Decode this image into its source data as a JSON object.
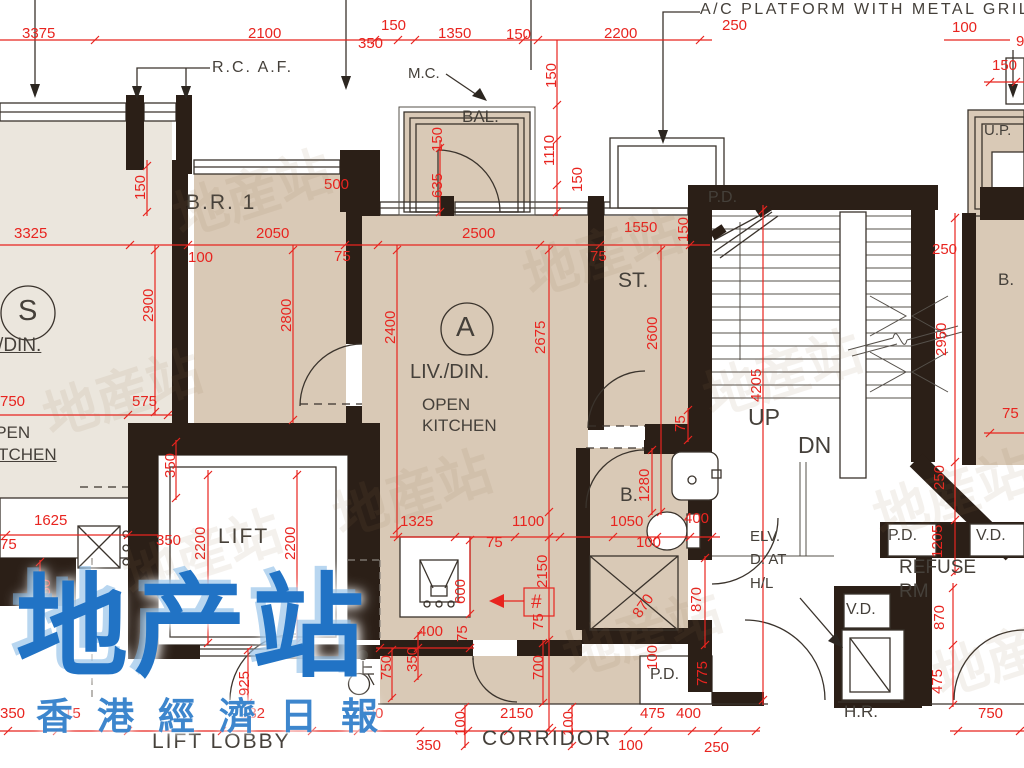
{
  "plan_title": "A/C PLATFORM WITH METAL GRILLE",
  "colors": {
    "red": "#e8241f",
    "wall": "#2b1f17",
    "ink": "#45403a",
    "tan": "#d9c9b6",
    "light": "#ebe6dd",
    "watermark_blue": "#2173c5"
  },
  "watermark": {
    "main": "地产站",
    "sub": "香港經濟日報",
    "ghost": "地産站"
  },
  "room_labels": [
    {
      "t": "A/C PLATFORM WITH METAL GRILLE",
      "x": 700,
      "y": 2,
      "s": 16,
      "ls": 2.5
    },
    {
      "t": "R.C. A.F.",
      "x": 212,
      "y": 60,
      "s": 16,
      "ls": 2
    },
    {
      "t": "M.C.",
      "x": 408,
      "y": 66,
      "s": 15
    },
    {
      "t": "BAL.",
      "x": 462,
      "y": 108,
      "s": 17
    },
    {
      "t": "B.R. 1",
      "x": 186,
      "y": 192,
      "s": 21,
      "ls": 2
    },
    {
      "t": "S",
      "x": 18,
      "y": 297,
      "s": 29
    },
    {
      "t": "LIV./DIN.",
      "x": -34,
      "y": 336,
      "s": 19,
      "u": 1
    },
    {
      "t": "OPEN",
      "x": -18,
      "y": 424,
      "s": 17
    },
    {
      "t": "KITCHEN",
      "x": -18,
      "y": 446,
      "s": 17,
      "u": 1
    },
    {
      "t": "A",
      "x": 456,
      "y": 313,
      "s": 28
    },
    {
      "t": "LIV./DIN.",
      "x": 410,
      "y": 362,
      "s": 20
    },
    {
      "t": "OPEN",
      "x": 422,
      "y": 396,
      "s": 17
    },
    {
      "t": "KITCHEN",
      "x": 422,
      "y": 417,
      "s": 17
    },
    {
      "t": "ST.",
      "x": 618,
      "y": 270,
      "s": 21
    },
    {
      "t": "B.",
      "x": 620,
      "y": 486,
      "s": 19
    },
    {
      "t": "UP",
      "x": 748,
      "y": 406,
      "s": 23
    },
    {
      "t": "DN",
      "x": 798,
      "y": 434,
      "s": 23
    },
    {
      "t": "P.D.",
      "x": 708,
      "y": 190,
      "s": 16
    },
    {
      "t": "P.D.",
      "x": 650,
      "y": 667,
      "s": 16
    },
    {
      "t": "P.D.",
      "x": 888,
      "y": 528,
      "s": 16
    },
    {
      "t": "V.D.",
      "x": 976,
      "y": 528,
      "s": 16
    },
    {
      "t": "V.D.",
      "x": 846,
      "y": 602,
      "s": 16
    },
    {
      "t": "ELV.",
      "x": 750,
      "y": 529,
      "s": 15
    },
    {
      "t": "D. AT",
      "x": 750,
      "y": 552,
      "s": 15
    },
    {
      "t": "H/L",
      "x": 750,
      "y": 576,
      "s": 15
    },
    {
      "t": "REFUSE",
      "x": 899,
      "y": 558,
      "s": 19
    },
    {
      "t": "RM",
      "x": 899,
      "y": 582,
      "s": 19
    },
    {
      "t": "H.R.",
      "x": 844,
      "y": 703,
      "s": 17
    },
    {
      "t": "U.P.",
      "x": 984,
      "y": 123,
      "s": 15
    },
    {
      "t": "B.",
      "x": 998,
      "y": 271,
      "s": 17
    },
    {
      "t": "LIFT",
      "x": 218,
      "y": 526,
      "s": 21,
      "ls": 2
    },
    {
      "t": "LIFT LOBBY",
      "x": 152,
      "y": 731,
      "s": 21,
      "ls": 2
    },
    {
      "t": "CORRIDOR",
      "x": 482,
      "y": 728,
      "s": 21,
      "ls": 2
    }
  ],
  "dim_labels": [
    {
      "t": "3375",
      "x": 22,
      "y": 26
    },
    {
      "t": "2100",
      "x": 248,
      "y": 26
    },
    {
      "t": "350",
      "x": 358,
      "y": 36
    },
    {
      "t": "150",
      "x": 381,
      "y": 18
    },
    {
      "t": "1350",
      "x": 438,
      "y": 26
    },
    {
      "t": "150",
      "x": 506,
      "y": 27
    },
    {
      "t": "2200",
      "x": 604,
      "y": 26
    },
    {
      "t": "250",
      "x": 722,
      "y": 18
    },
    {
      "t": "100",
      "x": 952,
      "y": 20
    },
    {
      "t": "9",
      "x": 1016,
      "y": 34
    },
    {
      "t": "150",
      "x": 992,
      "y": 58
    },
    {
      "t": "3325",
      "x": 14,
      "y": 226
    },
    {
      "t": "2050",
      "x": 256,
      "y": 226
    },
    {
      "t": "2500",
      "x": 462,
      "y": 226
    },
    {
      "t": "1550",
      "x": 624,
      "y": 220
    },
    {
      "t": "150",
      "x": 676,
      "y": 242,
      "r": -90
    },
    {
      "t": "100",
      "x": 188,
      "y": 250
    },
    {
      "t": "75",
      "x": 334,
      "y": 249
    },
    {
      "t": "75",
      "x": 590,
      "y": 249
    },
    {
      "t": "250",
      "x": 932,
      "y": 242
    },
    {
      "t": "500",
      "x": 324,
      "y": 177
    },
    {
      "t": "150",
      "x": 133,
      "y": 200,
      "r": -90
    },
    {
      "t": "150",
      "x": 430,
      "y": 152,
      "r": -90
    },
    {
      "t": "635",
      "x": 430,
      "y": 198,
      "r": -90
    },
    {
      "t": "150",
      "x": 544,
      "y": 88,
      "r": -90
    },
    {
      "t": "1110",
      "x": 542,
      "y": 166,
      "r": -90
    },
    {
      "t": "150",
      "x": 570,
      "y": 192,
      "r": -90
    },
    {
      "t": "2900",
      "x": 141,
      "y": 322,
      "r": -90
    },
    {
      "t": "2800",
      "x": 279,
      "y": 332,
      "r": -90
    },
    {
      "t": "2400",
      "x": 383,
      "y": 344,
      "r": -90
    },
    {
      "t": "2675",
      "x": 533,
      "y": 354,
      "r": -90
    },
    {
      "t": "2600",
      "x": 645,
      "y": 350,
      "r": -90
    },
    {
      "t": "4205",
      "x": 749,
      "y": 402,
      "r": -90
    },
    {
      "t": "2950",
      "x": 934,
      "y": 356,
      "r": -90
    },
    {
      "t": "250",
      "x": 932,
      "y": 490,
      "r": -90
    },
    {
      "t": "1205",
      "x": 930,
      "y": 558,
      "r": -90
    },
    {
      "t": "870",
      "x": 932,
      "y": 630,
      "r": -90
    },
    {
      "t": "475",
      "x": 930,
      "y": 694,
      "r": -90
    },
    {
      "t": "75",
      "x": 1002,
      "y": 406
    },
    {
      "t": "750",
      "x": 0,
      "y": 394
    },
    {
      "t": "575",
      "x": 132,
      "y": 394
    },
    {
      "t": "1625",
      "x": 34,
      "y": 513
    },
    {
      "t": "75",
      "x": 0,
      "y": 537
    },
    {
      "t": "350",
      "x": 156,
      "y": 533
    },
    {
      "t": "350",
      "x": 163,
      "y": 478,
      "r": -90
    },
    {
      "t": "2200",
      "x": 193,
      "y": 560,
      "r": -90
    },
    {
      "t": "2200",
      "x": 283,
      "y": 560,
      "r": -90
    },
    {
      "t": "350",
      "x": 38,
      "y": 604,
      "r": -90
    },
    {
      "t": "1325",
      "x": 400,
      "y": 514
    },
    {
      "t": "1100",
      "x": 512,
      "y": 514
    },
    {
      "t": "1050",
      "x": 610,
      "y": 514
    },
    {
      "t": "400",
      "x": 684,
      "y": 511
    },
    {
      "t": "75",
      "x": 486,
      "y": 535
    },
    {
      "t": "100",
      "x": 636,
      "y": 535
    },
    {
      "t": "2150",
      "x": 535,
      "y": 588,
      "r": -90
    },
    {
      "t": "600",
      "x": 453,
      "y": 604,
      "r": -90
    },
    {
      "t": "1280",
      "x": 637,
      "y": 502,
      "r": -90
    },
    {
      "t": "75",
      "x": 673,
      "y": 432,
      "r": -90
    },
    {
      "t": "870",
      "x": 630,
      "y": 612,
      "r": -55
    },
    {
      "t": "870",
      "x": 689,
      "y": 612,
      "r": -90
    },
    {
      "t": "100",
      "x": 645,
      "y": 670,
      "r": -90
    },
    {
      "t": "925",
      "x": 237,
      "y": 696,
      "r": -90
    },
    {
      "t": "750",
      "x": 379,
      "y": 680,
      "r": -90
    },
    {
      "t": "350",
      "x": 405,
      "y": 672,
      "r": -90
    },
    {
      "t": "400",
      "x": 418,
      "y": 624
    },
    {
      "t": "75",
      "x": 455,
      "y": 642,
      "r": -90
    },
    {
      "t": "700",
      "x": 531,
      "y": 680,
      "r": -90
    },
    {
      "t": "75",
      "x": 531,
      "y": 630,
      "r": -90
    },
    {
      "t": "775",
      "x": 695,
      "y": 686,
      "r": -90
    },
    {
      "t": "100",
      "x": 453,
      "y": 736,
      "r": -90
    },
    {
      "t": "100",
      "x": 561,
      "y": 736,
      "r": -90
    },
    {
      "t": "350",
      "x": 0,
      "y": 706
    },
    {
      "t": "15",
      "x": 64,
      "y": 706
    },
    {
      "t": "182",
      "x": 240,
      "y": 706
    },
    {
      "t": "1000",
      "x": 350,
      "y": 706
    },
    {
      "t": "2150",
      "x": 500,
      "y": 706
    },
    {
      "t": "475",
      "x": 640,
      "y": 706
    },
    {
      "t": "400",
      "x": 676,
      "y": 706
    },
    {
      "t": "350",
      "x": 416,
      "y": 738
    },
    {
      "t": "100",
      "x": 618,
      "y": 738
    },
    {
      "t": "250",
      "x": 704,
      "y": 740
    },
    {
      "t": "750",
      "x": 978,
      "y": 706
    },
    {
      "t": "#",
      "x": 531,
      "y": 593,
      "s": 19
    }
  ]
}
